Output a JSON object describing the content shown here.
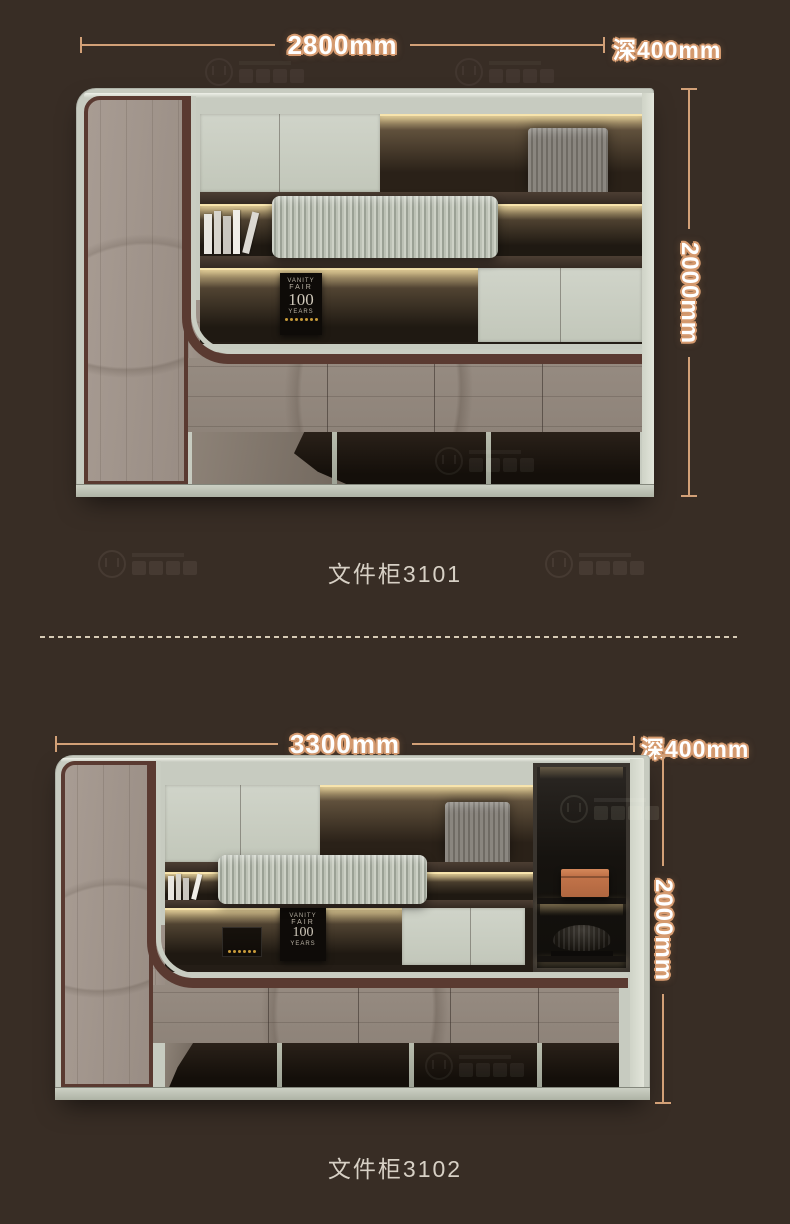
{
  "page": {
    "background_color": "#382d25"
  },
  "colors": {
    "dimension_accent": "#d2a077",
    "dimension_text": "#ffffff",
    "dimension_outline": "#d59a6f",
    "caption_text": "#d7d0c5",
    "divider_dash": "#e7dcc5",
    "cabinet_frame_sage": "#c7cbc0",
    "cabinet_wood": "#9a8e85",
    "trim_maroon": "#5a3a31",
    "led_glow": "#f7e4ad",
    "recess_dark": "#1c1610",
    "dark_column": "#1d1a17",
    "orange_box": "#c3744a"
  },
  "magazine": {
    "line1": "VANITY",
    "line2": "FAIR",
    "line3": "100",
    "line4": "YEARS"
  },
  "sections": [
    {
      "caption": "文件柜3101",
      "width_label": "2800mm",
      "depth_label": "深400mm",
      "height_label": "2000mm"
    },
    {
      "caption": "文件柜3102",
      "width_label": "3300mm",
      "depth_label": "深400mm",
      "height_label": "2000mm"
    }
  ]
}
